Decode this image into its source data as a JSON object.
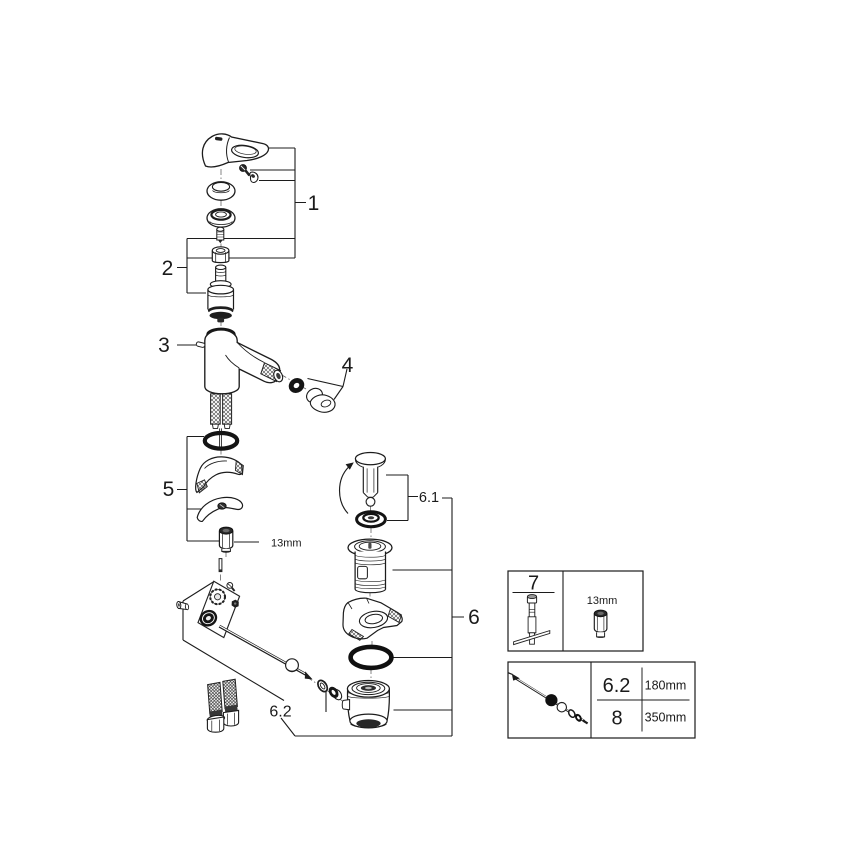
{
  "figure": {
    "type": "exploded-parts-diagram",
    "background": "#ffffff",
    "line_color": "#1c1c1c"
  },
  "callouts": {
    "handle_group": "1",
    "cartridge_group": "2",
    "body": "3",
    "aerator": "4",
    "mounting_set": "5",
    "drain_set": "6",
    "drain_plug": "6.1",
    "popup_rod": "6.2",
    "nut_size": "13mm"
  },
  "tool_box": {
    "part_no": "7",
    "socket_size": "13mm"
  },
  "rod_box": {
    "rows": [
      {
        "part_no": "6.2",
        "length": "180mm"
      },
      {
        "part_no": "8",
        "length": "350mm"
      }
    ]
  }
}
